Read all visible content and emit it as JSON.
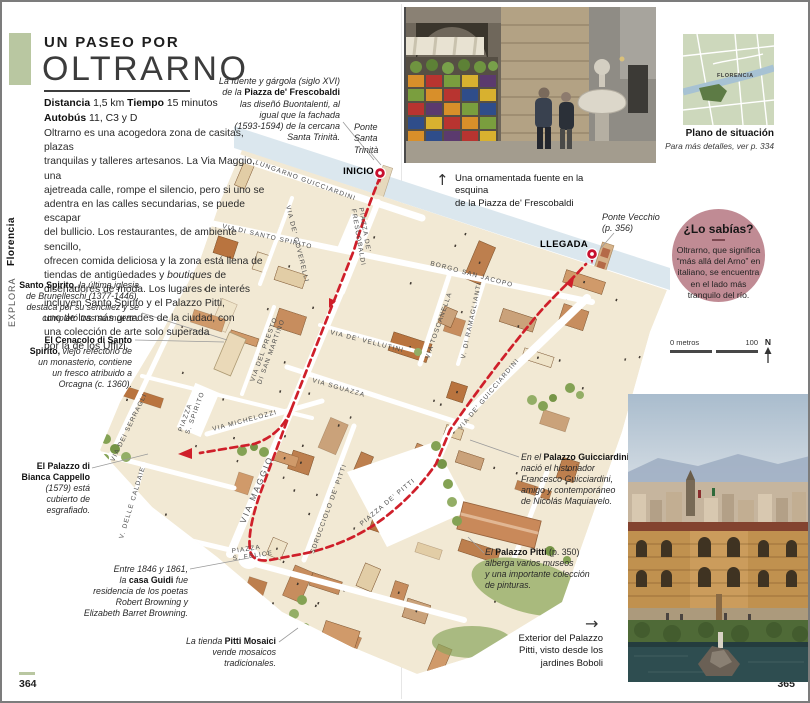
{
  "page": {
    "left_number": "364",
    "right_number": "365"
  },
  "sidebar": {
    "section": "EXPLORA",
    "region": "Florencia"
  },
  "header": {
    "kicker": "UN PASEO POR",
    "title": "OLTRARNO"
  },
  "stats": {
    "line1": [
      {
        "t": "Distancia",
        "s": "b"
      },
      {
        "t": " 1,5 km   ",
        "s": "r"
      },
      {
        "t": "Tiempo",
        "s": "b"
      },
      {
        "t": " 15 minutos",
        "s": "r"
      }
    ],
    "line2": [
      {
        "t": "Autobús",
        "s": "b"
      },
      {
        "t": " 11, C3 y D",
        "s": "r"
      }
    ]
  },
  "intro": [
    {
      "t": "Oltrarno es una acogedora zona de casitas, plazas\ntranquilas y talleres artesanos. La Via Maggio, una\najetreada calle, rompe el silencio, pero si uno se\nadentra en las calles secundarias, se puede escapar\ndel bullicio. Los restaurantes, de ambiente sencillo,\nofrecen comida deliciosa y la zona está llena de\ntiendas de antigüedades y ",
      "s": "r"
    },
    {
      "t": "boutiques",
      "s": "i"
    },
    {
      "t": " de\ndiseñadores de moda. Los lugares de interés\nincluyen Santo Spirito y el Palazzo Pitti,\nuno de los más grandes de la ciudad, con\nuna colección de arte solo superada\npor la de los Uffizi.",
      "s": "r"
    }
  ],
  "callouts": {
    "frescobaldi": [
      {
        "t": "La fuente y gárgola (siglo XVI)\nde la ",
        "s": "i"
      },
      {
        "t": "Piazza de' Frescobaldi",
        "s": "b"
      },
      {
        "t": "\nlas diseñó Buontalenti, al\nigual que la fachada\n(1593-1594) de la cercana\nSanta Trinità.",
        "s": "i"
      }
    ],
    "trinita": [
      {
        "t": "Ponte\nSanta\nTrinità",
        "s": "i"
      }
    ],
    "vecchio": [
      {
        "t": "Ponte Vecchio\n(p. 356)",
        "s": "i"
      }
    ],
    "spirito": [
      {
        "t": "Santo Spirito,",
        "s": "b"
      },
      {
        "t": " la última iglesia\nde Brunelleschi (1377-1446),\ndestaca por su sencillez y se\ncompletó tras su muerte.",
        "s": "i"
      }
    ],
    "cenacolo": [
      {
        "t": "El Cenacolo di Santo\nSpirito,",
        "s": "b"
      },
      {
        "t": " viejo refectorio de\nun monasterio, contiene\nun fresco atribuido a\nOrcagna (c. 1360).",
        "s": "i"
      }
    ],
    "bianca": [
      {
        "t": "El Palazzo di\nBianca Cappello",
        "s": "b"
      },
      {
        "t": "\n(1579) está\ncubierto de\nesgrafiado.",
        "s": "i"
      }
    ],
    "guidi": [
      {
        "t": "Entre 1846 y 1861,\nla ",
        "s": "i"
      },
      {
        "t": "casa Guidi",
        "s": "b"
      },
      {
        "t": " fue\nresidencia de los poetas\nRobert Browning y\nElizabeth Barret Browning.",
        "s": "i"
      }
    ],
    "mosaici": [
      {
        "t": "La tienda ",
        "s": "i"
      },
      {
        "t": "Pitti Mosaici",
        "s": "b"
      },
      {
        "t": "\nvende mosaicos\ntradicionales.",
        "s": "i"
      }
    ],
    "guicciardini": [
      {
        "t": "En el ",
        "s": "i"
      },
      {
        "t": "Palazzo Guicciardini",
        "s": "b"
      },
      {
        "t": "\nnació el historiador\nFrancesco Guicciardini,\namigo y contemporáneo\nde Nicolás Maquiavelo.",
        "s": "i"
      }
    ],
    "pitti": [
      {
        "t": "El ",
        "s": "i"
      },
      {
        "t": "Palazzo Pitti",
        "s": "b"
      },
      {
        "t": " (p. 350)",
        "s": "r"
      },
      {
        "t": "\nalberga varios museos\ny una importante colección\nde pinturas.",
        "s": "i"
      }
    ]
  },
  "captions": {
    "top_arrow": "↑",
    "top": "Una ornamentada fuente en la esquina\nde la Piazza de' Frescobaldi",
    "right_arrow": "→",
    "right": "Exterior del Palazzo\nPitti, visto desde los\njardines Boboli"
  },
  "locator": {
    "city": "FLORENCIA",
    "title": "Plano de situación",
    "subtitle": "Para más detalles, ver p. 334"
  },
  "knowbox": {
    "title": "¿Lo sabías?",
    "body": "Oltrarno, que significa\n“más allá del Arno” en\nitaliano, se encuentra\nen el lado más\ntranquilo del río."
  },
  "scalebar": {
    "start": "0 metros",
    "end": "100",
    "north": "N"
  },
  "map": {
    "markers": {
      "start": "INICIO",
      "end": "LLEGADA"
    },
    "colors": {
      "route": "#cf1f2a",
      "pin": "#c8102e",
      "river": "#dbe7ee",
      "accent_green": "#b9c7a1",
      "circle_pink": "#c08b94"
    },
    "streets": [
      {
        "t": "LUNGARNO GUICCIARDINI",
        "x": 253,
        "y": 162,
        "r": 20
      },
      {
        "t": "VIA DI SANTO SPIRITO",
        "x": 220,
        "y": 226,
        "r": 13
      },
      {
        "t": "BORGO SAN JACOPO",
        "x": 428,
        "y": 263,
        "r": 15
      },
      {
        "t": "VIA DE' COVERELLI",
        "x": 284,
        "y": 204,
        "r": 76
      },
      {
        "t": "PIAZZA DE'|FRESCOBALDI",
        "x": 357,
        "y": 206,
        "r": 80
      },
      {
        "t": "VIA DE' VELLUTINI",
        "x": 328,
        "y": 332,
        "r": 14
      },
      {
        "t": "VIA SGUAZZA",
        "x": 310,
        "y": 380,
        "r": 16
      },
      {
        "t": "VIA DEL PRESTO|DI SAN MARTINO",
        "x": 252,
        "y": 380,
        "r": -70
      },
      {
        "t": "VIA MICHELOZZI",
        "x": 211,
        "y": 429,
        "r": -15
      },
      {
        "t": "VIA MAGGIO",
        "x": 243,
        "y": 522,
        "r": -67,
        "big": true
      },
      {
        "t": "SDRUCCIOLO DE' PITTI",
        "x": 312,
        "y": 552,
        "r": -70
      },
      {
        "t": "VIA TOSCANELLA",
        "x": 427,
        "y": 357,
        "r": -71
      },
      {
        "t": "V. DI RAMAGLIANTI",
        "x": 463,
        "y": 357,
        "r": -78
      },
      {
        "t": "VIA DE' GUICCIARDINI",
        "x": 459,
        "y": 428,
        "r": -50
      },
      {
        "t": "PIAZZA DE' PITTI",
        "x": 360,
        "y": 524,
        "r": -40
      },
      {
        "t": "PIAZZA|S. FELICE",
        "x": 230,
        "y": 551,
        "r": -8
      },
      {
        "t": "PIAZZA|S. SPIRITO",
        "x": 180,
        "y": 430,
        "r": -70
      },
      {
        "t": "V. DELLE CALDAIE",
        "x": 121,
        "y": 537,
        "r": -73
      },
      {
        "t": "VIA DEI SERRAGLI",
        "x": 112,
        "y": 460,
        "r": -64
      }
    ]
  }
}
